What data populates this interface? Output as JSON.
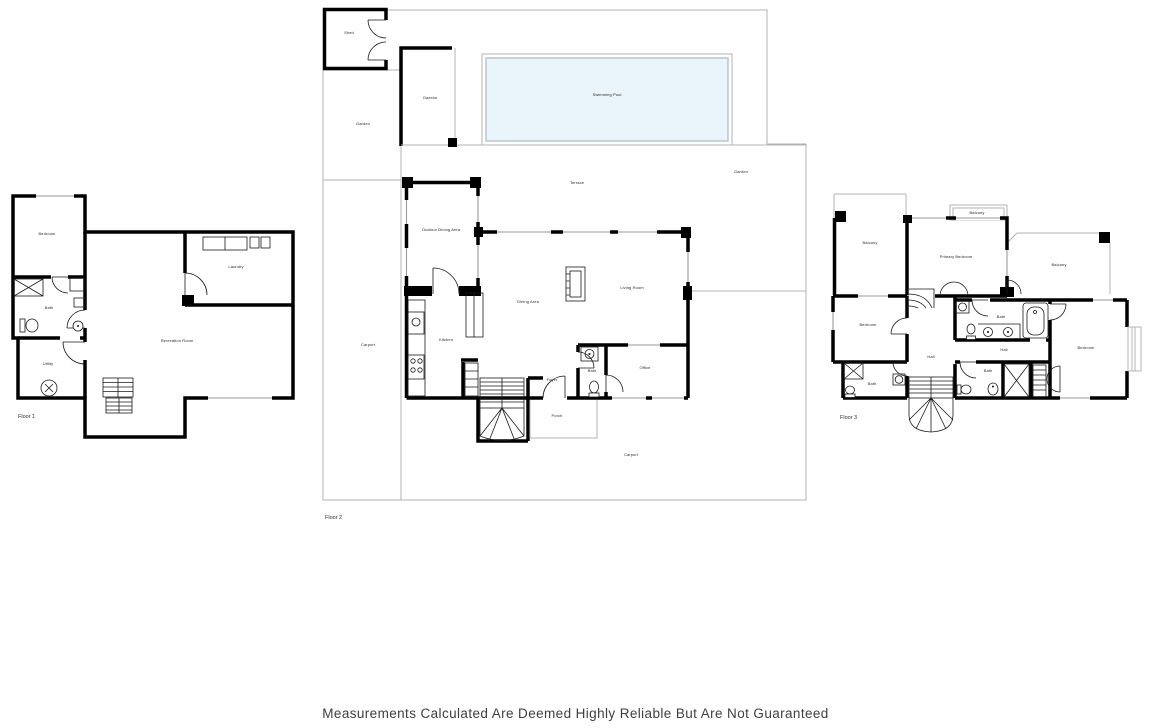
{
  "disclaimer": "Measurements Calculated Are Deemed Highly Reliable But Are Not Guaranteed",
  "colors": {
    "wall": "#000000",
    "thin_line": "#b3b3b3",
    "pool_fill": "#e9f4fb",
    "pool_border": "#b9c6cc",
    "label_text": "#2a2a2a"
  },
  "floors": [
    {
      "label": "Floor 1",
      "rooms": [
        {
          "name": "Bedroom"
        },
        {
          "name": "Bath"
        },
        {
          "name": "Utility"
        },
        {
          "name": "Laundry"
        },
        {
          "name": "Recreation Room"
        }
      ]
    },
    {
      "label": "Floor 2",
      "rooms": [
        {
          "name": "Shed"
        },
        {
          "name": "Gazebo"
        },
        {
          "name": "Garden"
        },
        {
          "name": "Swimming Pool"
        },
        {
          "name": "Terrace"
        },
        {
          "name": "Garden"
        },
        {
          "name": "Outdoor Dining Area"
        },
        {
          "name": "Dining Area"
        },
        {
          "name": "Living Room"
        },
        {
          "name": "Kitchen"
        },
        {
          "name": "Carport"
        },
        {
          "name": "Foyer"
        },
        {
          "name": "Bath"
        },
        {
          "name": "Office"
        },
        {
          "name": "Porch"
        },
        {
          "name": "Carport"
        }
      ]
    },
    {
      "label": "Floor 3",
      "rooms": [
        {
          "name": "Balcony"
        },
        {
          "name": "Balcony"
        },
        {
          "name": "Primary Bedroom"
        },
        {
          "name": "Balcony"
        },
        {
          "name": "Bedroom"
        },
        {
          "name": "Bath"
        },
        {
          "name": "Hall"
        },
        {
          "name": "Hall"
        },
        {
          "name": "Bedroom"
        },
        {
          "name": "Bath"
        },
        {
          "name": "Bath"
        }
      ]
    }
  ]
}
